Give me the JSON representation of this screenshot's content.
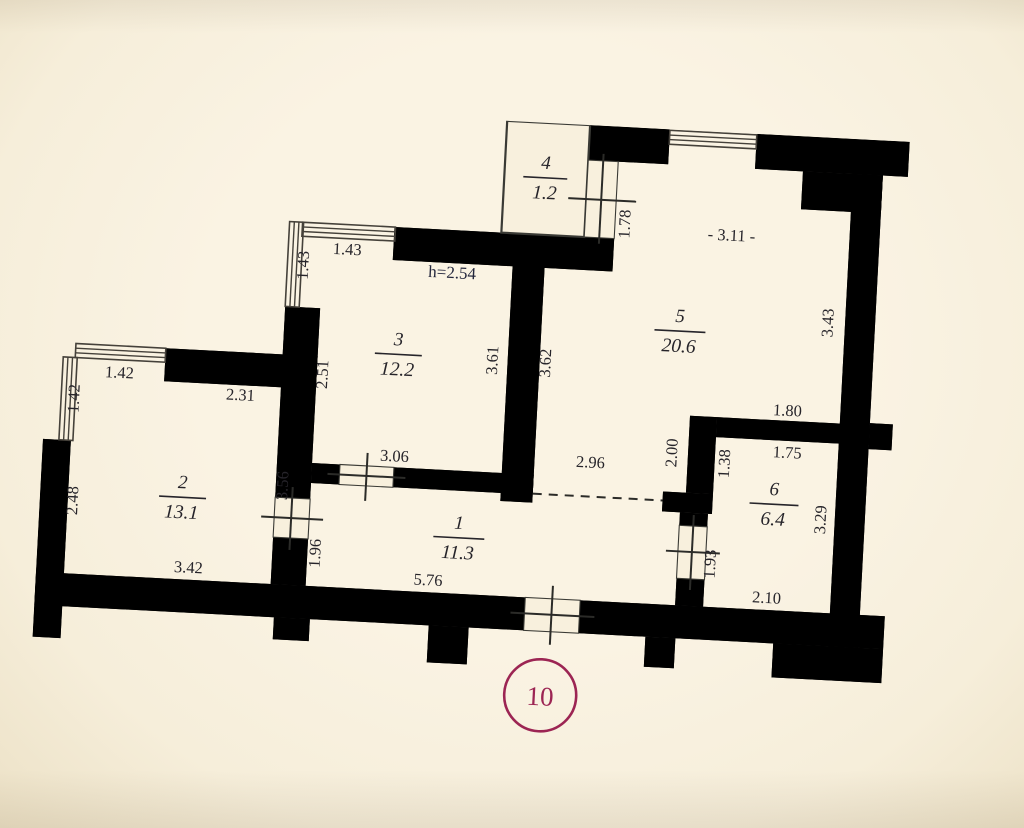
{
  "plan": {
    "unit_number": "10",
    "height_note": "h=2.54",
    "rooms": [
      {
        "number": "1",
        "area": "11.3"
      },
      {
        "number": "2",
        "area": "13.1"
      },
      {
        "number": "3",
        "area": "12.2"
      },
      {
        "number": "4",
        "area": "1.2"
      },
      {
        "number": "5",
        "area": "20.6"
      },
      {
        "number": "6",
        "area": "6.4"
      }
    ],
    "dimensions": {
      "room3_window_top": "1.43",
      "room3_window_side": "1.43",
      "room2_window_top": "1.42",
      "room2_window_side": "1.42",
      "room2_top": "2.31",
      "room2_left": "2.48",
      "room2_bottom": "3.42",
      "room2_right": "3.56",
      "room1_left": "1.96",
      "room3_left": "2.51",
      "room3_right": "3.61",
      "room5_left": "3.62",
      "room3_bottom": "3.06",
      "room5_opening": "2.96",
      "room1_bottom": "5.76",
      "room4_side": "1.78",
      "room5_top": "- 3.11 -",
      "room5_right": "3.43",
      "room5_nook_wall": "2.00",
      "room6_wall_upper": "1.38",
      "room56_wall_top": "1.80",
      "room56_wall_bottom": "1.75",
      "room6_left": "1.93",
      "room6_right": "3.29",
      "room6_bottom": "2.10"
    },
    "colors": {
      "wall": "#a5336b",
      "background": "#f8f0dd",
      "line": "#2b2b28",
      "accent": "#9c2553"
    }
  }
}
